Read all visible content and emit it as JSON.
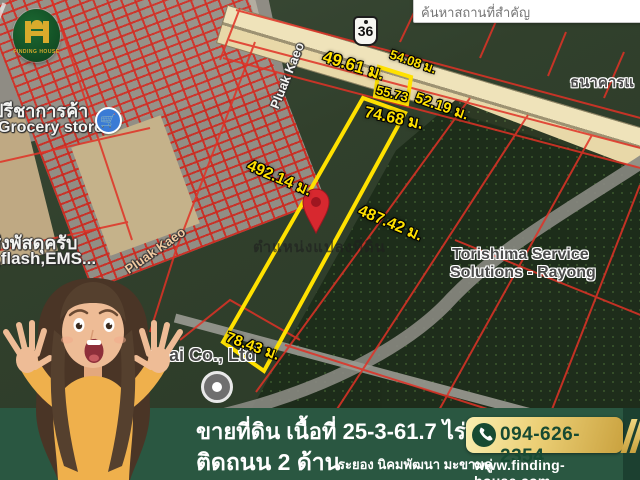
{
  "logo": {
    "name": "FINDING HOUSE"
  },
  "search": {
    "placeholder": "ค้นหาสถานที่สำคัญ"
  },
  "map": {
    "road_badge": "36",
    "measurements": [
      "49.61 ม.",
      "54.08 ม.",
      "55.73",
      "52.19 ม.",
      "74.68 ม.",
      "492.14 ม.",
      "487.42 ม.",
      "78.43 ม."
    ],
    "labels": {
      "road_1": "Pluak Kaeo",
      "road_2": "Pluak Kaeo",
      "grocery_thai": "ปรีชาการค้า",
      "grocery_en": "Grocery store",
      "parcel_thai": "ส่งพัสดุครับ",
      "parcel_en": ",flash,EMS...",
      "bank": "ธนาคารแ",
      "torishima_line1": "Torishima Service",
      "torishima_line2": "Solutions - Rayong",
      "company": "nkai Co., Ltd",
      "pin_caption": "ตำแหน่งแปลงที่ดิน"
    }
  },
  "banner": {
    "line1": "ขายที่ดิน เนื้อที่ 25-3-61.7 ไร่",
    "line2": "ติดถนน 2 ด้าน",
    "line2_sub": "ระยอง นิคมพัฒนา มะขามคู่",
    "phone": "094-626-2354",
    "website": "www.finding-house.com"
  },
  "colors": {
    "banner_green": "#2a5741",
    "plot_outline_yellow": "#ffe100",
    "pin_red": "#d7282f",
    "cadastral_red": "#e03226",
    "gold": "#ecd077",
    "logo_green": "#114a22"
  }
}
